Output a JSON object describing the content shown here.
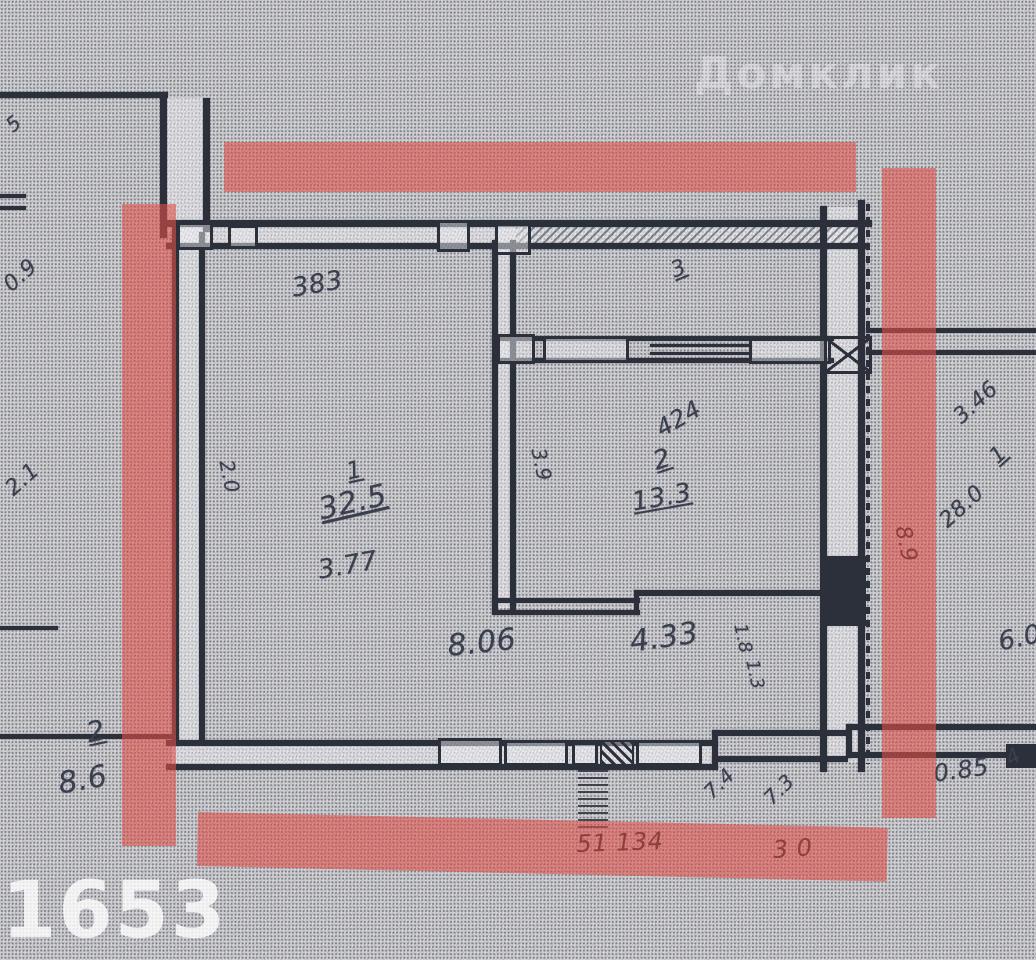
{
  "colors": {
    "highlighter": "#e7524b",
    "paper": "#d6d6da",
    "ink": "#2c303b",
    "covered_ink": "#93403c"
  },
  "watermarks": {
    "photo_id": "1653",
    "site_watermark": "Домклик"
  },
  "labels": [
    {
      "name": "dim-383",
      "text": "383",
      "x": 290,
      "y": 276,
      "rot": -10,
      "size": 26
    },
    {
      "name": "room3-number",
      "text": "3",
      "x": 668,
      "y": 262,
      "rot": -22,
      "size": 22,
      "underline": true
    },
    {
      "name": "dim-left-2-0",
      "text": "2.0",
      "x": 236,
      "y": 458,
      "rot": 78,
      "size": 20
    },
    {
      "name": "room1-number",
      "text": "1",
      "x": 344,
      "y": 460,
      "rot": -12,
      "size": 24,
      "underline": true
    },
    {
      "name": "room1-area",
      "text": "32.5",
      "x": 316,
      "y": 496,
      "rot": -13,
      "size": 30,
      "underline": true
    },
    {
      "name": "room1-dim-3-77",
      "text": "3.77",
      "x": 316,
      "y": 558,
      "rot": -10,
      "size": 26
    },
    {
      "name": "dim-3-9",
      "text": "3.9",
      "x": 548,
      "y": 446,
      "rot": 78,
      "size": 20
    },
    {
      "name": "room2-dim-424",
      "text": "424",
      "x": 652,
      "y": 420,
      "rot": -30,
      "size": 24
    },
    {
      "name": "room2-number",
      "text": "2",
      "x": 650,
      "y": 450,
      "rot": -18,
      "size": 26,
      "underline": true
    },
    {
      "name": "room2-area",
      "text": "13.3",
      "x": 630,
      "y": 490,
      "rot": -10,
      "size": 26,
      "underline": true
    },
    {
      "name": "dim-8-06",
      "text": "8.06",
      "x": 446,
      "y": 632,
      "rot": -6,
      "size": 30
    },
    {
      "name": "dim-4-33",
      "text": "4.33",
      "x": 628,
      "y": 628,
      "rot": -8,
      "size": 30
    },
    {
      "name": "dim-1-8",
      "text": "1.8",
      "x": 748,
      "y": 622,
      "rot": 78,
      "size": 18
    },
    {
      "name": "dim-1-3",
      "text": "1.3",
      "x": 760,
      "y": 658,
      "rot": 78,
      "size": 18
    },
    {
      "name": "neighbor-room-number",
      "text": "2",
      "x": 84,
      "y": 720,
      "rot": -12,
      "size": 28,
      "underline": true
    },
    {
      "name": "neighbor-room-area",
      "text": "8.6",
      "x": 56,
      "y": 770,
      "rot": -10,
      "size": 30
    },
    {
      "name": "right-dim-3-46",
      "text": "3.46",
      "x": 950,
      "y": 412,
      "rot": -42,
      "size": 22
    },
    {
      "name": "right-room-number",
      "text": "1",
      "x": 986,
      "y": 452,
      "rot": -42,
      "size": 22,
      "underline": true
    },
    {
      "name": "right-room-area",
      "text": "28.0",
      "x": 936,
      "y": 516,
      "rot": -42,
      "size": 22
    },
    {
      "name": "dim-6-0",
      "text": "6.0",
      "x": 996,
      "y": 630,
      "rot": -12,
      "size": 26
    },
    {
      "name": "dim-0-85",
      "text": "0.85",
      "x": 932,
      "y": 762,
      "rot": -8,
      "size": 24
    },
    {
      "name": "dim-4",
      "text": "4",
      "x": 1002,
      "y": 752,
      "rot": -30,
      "size": 22
    },
    {
      "name": "dim-7-4",
      "text": "7.4",
      "x": 700,
      "y": 788,
      "rot": -45,
      "size": 20
    },
    {
      "name": "dim-7-3",
      "text": "7.3",
      "x": 760,
      "y": 794,
      "rot": -45,
      "size": 20
    },
    {
      "name": "covered-dim-51-134",
      "text": "51 134",
      "x": 576,
      "y": 832,
      "rot": -2,
      "size": 24,
      "color": "#93403c",
      "cover": true
    },
    {
      "name": "covered-dim-3-0",
      "text": "3 0",
      "x": 772,
      "y": 838,
      "rot": -4,
      "size": 24,
      "color": "#93403c",
      "cover": true
    },
    {
      "name": "covered-dim-8-9",
      "text": "8.9",
      "x": 912,
      "y": 524,
      "rot": 78,
      "size": 22,
      "color": "#93403c",
      "cover": true
    },
    {
      "name": "edge-dim-5",
      "text": "5",
      "x": 2,
      "y": 120,
      "rot": -40,
      "size": 20
    },
    {
      "name": "edge-dim-0-9",
      "text": "0.9",
      "x": 0,
      "y": 280,
      "rot": -42,
      "size": 22
    },
    {
      "name": "edge-dim-2-1",
      "text": "2.1",
      "x": 2,
      "y": 484,
      "rot": -42,
      "size": 22
    }
  ]
}
